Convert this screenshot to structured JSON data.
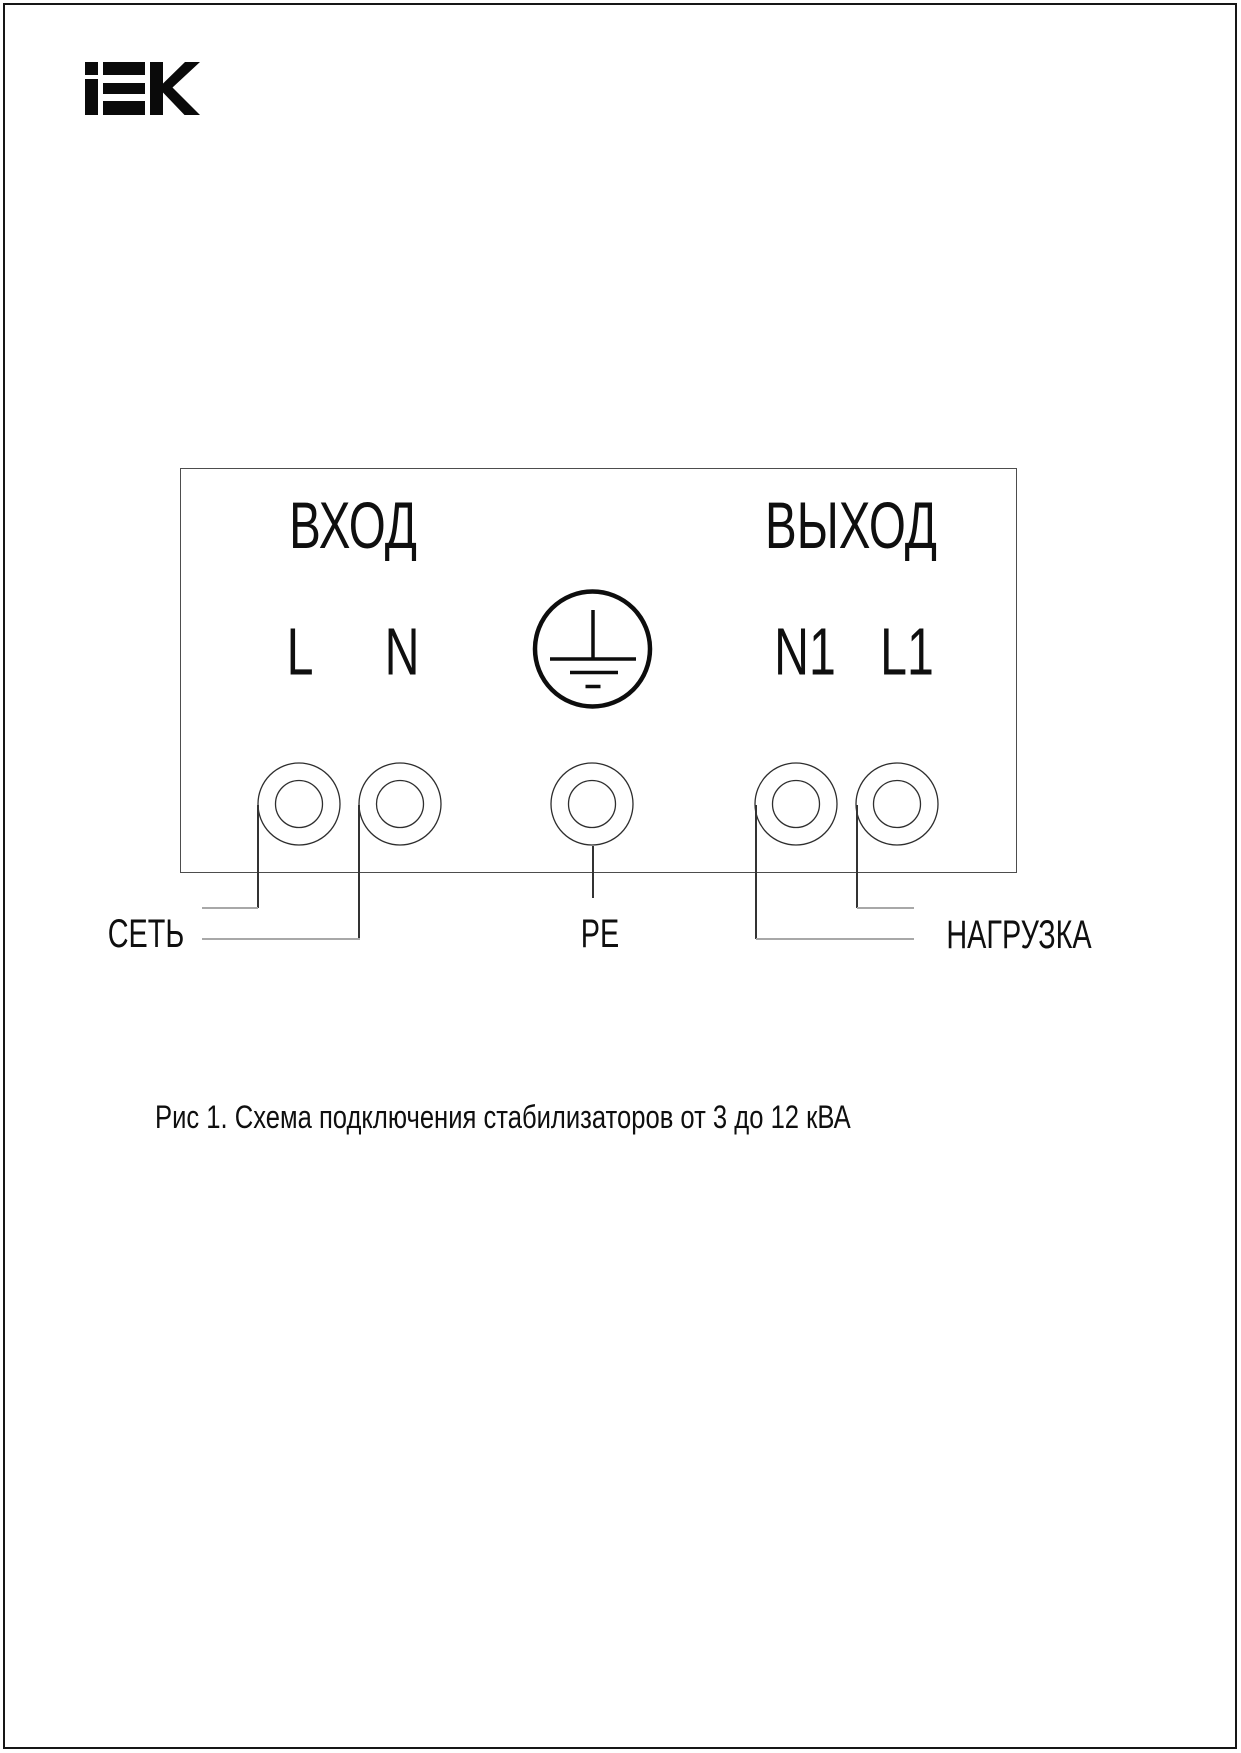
{
  "page": {
    "brand": "IEK",
    "caption": "Рис 1. Схема подключения стабилизаторов от 3 до 12 кВА"
  },
  "diagram": {
    "input_section_label": "ВХОД",
    "output_section_label": "ВЫХОД",
    "terminal_labels": {
      "l": "L",
      "n": "N",
      "n1": "N1",
      "l1": "L1"
    },
    "wire_labels": {
      "mains": "СЕТЬ",
      "earth": "PE",
      "load": "НАГРУЗКА"
    },
    "ground_icon": "protective-earth-icon"
  },
  "colors": {
    "ink": "#0f0f0f",
    "wire_dark": "#333333",
    "stub_gray": "#a8a8a8",
    "box_border": "#4d4d4d"
  }
}
